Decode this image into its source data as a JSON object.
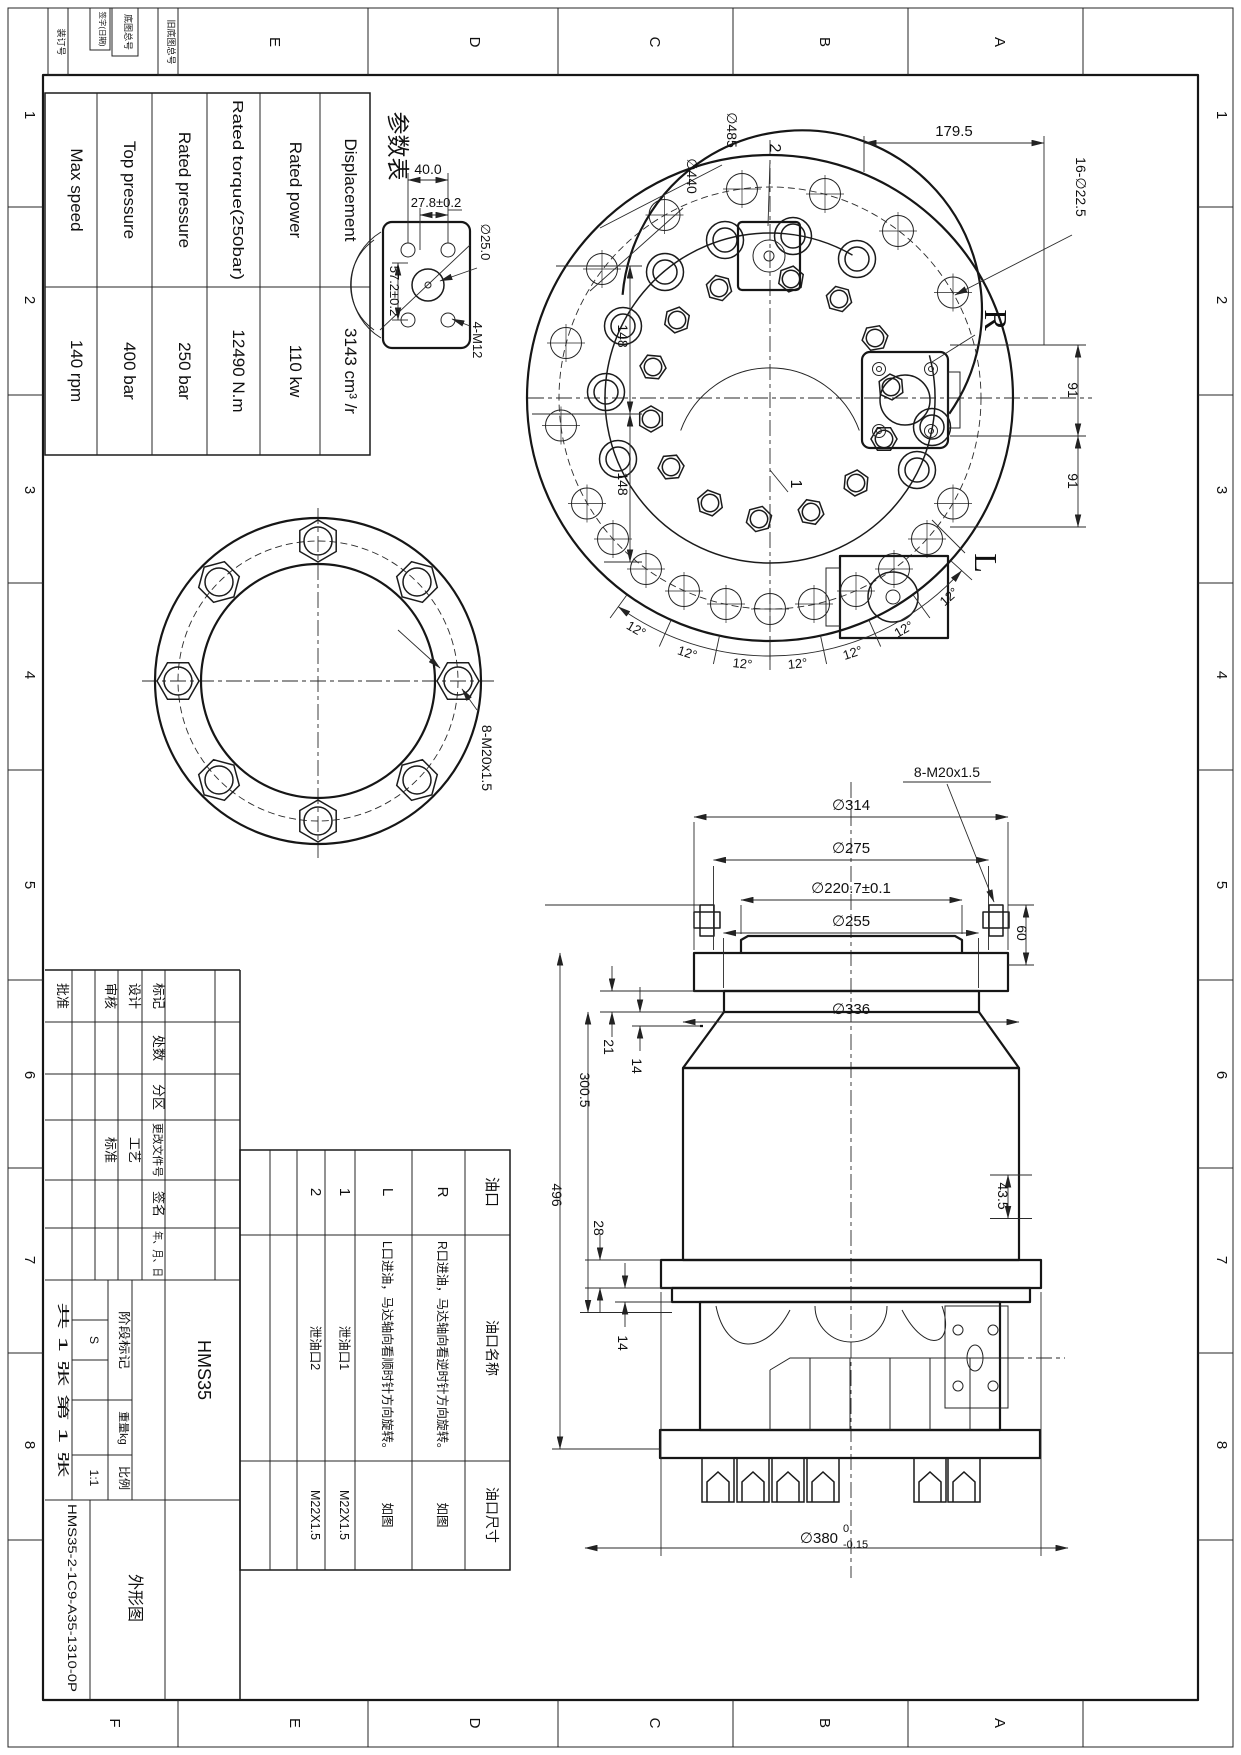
{
  "sheet": {
    "zone_letters": [
      "A",
      "B",
      "C",
      "D",
      "E",
      "F"
    ],
    "zone_numbers": [
      "1",
      "2",
      "3",
      "4",
      "5",
      "6",
      "7",
      "8"
    ],
    "margin_cells": {
      "binding_no": "装订号",
      "signature_date": "签字(日期)",
      "master_no": "底图总号",
      "old_master_no": "旧底图总号"
    }
  },
  "param_table": {
    "title": "参数表",
    "rows": [
      {
        "label": "Displacement",
        "value": "3143  cm³ /r"
      },
      {
        "label": "Rated power",
        "value": "110  kw"
      },
      {
        "label": "Rated torque(250bar)",
        "value": "12490  N.m"
      },
      {
        "label": "Rated pressure",
        "value": "250  bar"
      },
      {
        "label": "Top pressure",
        "value": "400  bar"
      },
      {
        "label": "Max speed",
        "value": "140  rpm"
      }
    ]
  },
  "detail_view": {
    "dim_width": "40.0",
    "dim_pitch": "27.8±0.2",
    "dim_height": "57.2±0.2",
    "dim_bore": "∅25.0",
    "dim_thread": "4-M12"
  },
  "front_view": {
    "dim_span": "179.5",
    "dim_bolt_holes": "16-∅22.5",
    "dim_od": "∅485",
    "dim_bcd": "∅440",
    "dim_upper": "148",
    "dim_lower": "148",
    "dim_r1": "91",
    "dim_r2": "91",
    "angle": "12°",
    "label_r": "R",
    "label_l": "L",
    "callout_1": "1",
    "callout_2": "2"
  },
  "flange_view": {
    "dim_thread": "8-M20x1.5"
  },
  "side_view": {
    "dim_d314": "∅314",
    "dim_d275": "∅275",
    "dim_d2207": "∅220.7±0.1",
    "dim_thread": "8-M20x1.5",
    "dim_60": "60",
    "dim_21": "21",
    "dim_14a": "14",
    "dim_d255": "∅255",
    "dim_3005": "300.5",
    "dim_496": "496",
    "dim_d336": "∅336",
    "dim_28": "28",
    "dim_14b": "14",
    "dim_435": "43.5",
    "dim_d380": "∅380",
    "tol_upper": "0",
    "tol_lower": "-0.15"
  },
  "port_table": {
    "col_port": "油口",
    "col_name": "油口名称",
    "col_size": "油口尺寸",
    "rows": [
      {
        "id": "R",
        "name": "R口进油，马达轴向看逆时针方向旋转。",
        "size": "如图"
      },
      {
        "id": "L",
        "name": "L口进油，马达轴向看顺时针方向旋转。",
        "size": "如图"
      },
      {
        "id": "1",
        "name": "泄油口1",
        "size": "M22X1.5"
      },
      {
        "id": "2",
        "name": "泄油口2",
        "size": "M22X1.5"
      }
    ]
  },
  "title_block": {
    "rev_headers": {
      "mark": "标记",
      "count": "处数",
      "zone": "分区",
      "doc_no": "更改文件号",
      "sign": "签名",
      "date": "年、月、日"
    },
    "roles": {
      "design": "设计",
      "check": "审核",
      "approve": "批准",
      "process": "工艺",
      "standard": "标准"
    },
    "stage": {
      "label": "阶段标记",
      "value": "S"
    },
    "weight": {
      "label": "重量kg"
    },
    "scale": {
      "label": "比例",
      "value": "1:1"
    },
    "sheets": "共 1 张 第 1 张",
    "model": "HMS35",
    "drawing_name": "外形图",
    "part_no": "HMS35-2-1C9-A35-1310-0P"
  }
}
